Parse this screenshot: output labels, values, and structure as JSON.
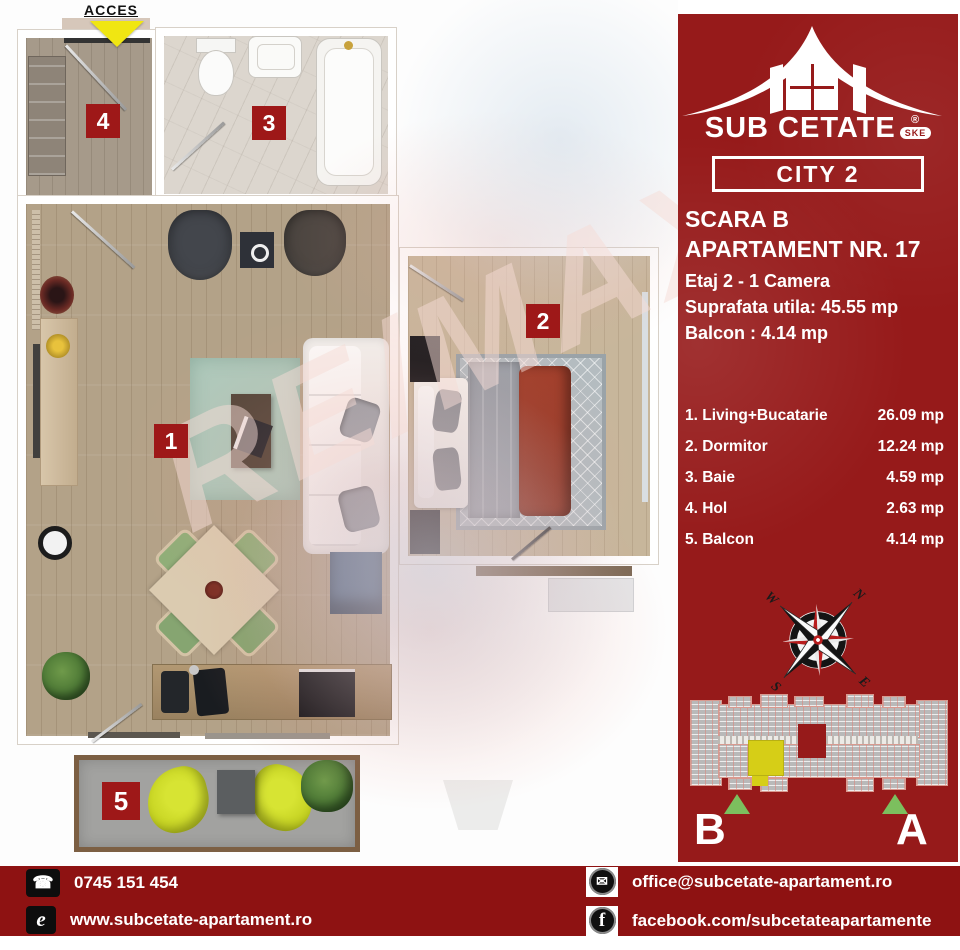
{
  "plan": {
    "acces_label": "ACCES",
    "room_numbers": [
      "1",
      "2",
      "3",
      "4",
      "5"
    ],
    "watermark_text": "RE/MAX"
  },
  "sidebar": {
    "logo": {
      "name": "SUB CETATE",
      "registered": "®",
      "badge": "SKE",
      "line2": "CITY 2"
    },
    "title_line1": "SCARA B",
    "title_line2": "APARTAMENT NR. 17",
    "detail_floor": "Etaj 2 - 1 Camera",
    "detail_area": "Suprafata utila: 45.55 mp",
    "detail_balcony": "Balcon : 4.14 mp",
    "room_list": [
      {
        "label": "1. Living+Bucatarie",
        "area": "26.09 mp"
      },
      {
        "label": "2. Dormitor",
        "area": "12.24 mp"
      },
      {
        "label": "3. Baie",
        "area": "4.59 mp"
      },
      {
        "label": "4. Hol",
        "area": "2.63 mp"
      },
      {
        "label": "5. Balcon",
        "area": "4.14 mp"
      }
    ],
    "compass": {
      "n": "N",
      "e": "E",
      "s": "S",
      "w": "W"
    },
    "building": {
      "entrance_left": "B",
      "entrance_right": "A"
    }
  },
  "footer": {
    "phone": "0745 151 454",
    "website": "www.subcetate-apartament.ro",
    "email": "office@subcetate-apartament.ro",
    "facebook": "facebook.com/subcetateapartamente"
  },
  "colors": {
    "sidebar_red": "#961a1a",
    "footer_red": "#8e1212",
    "badge_red": "#9e1818",
    "accent_yellow": "#f0e612",
    "highlight_unit_yellow": "#d6ce17",
    "entrance_green": "#7cbf5e"
  }
}
